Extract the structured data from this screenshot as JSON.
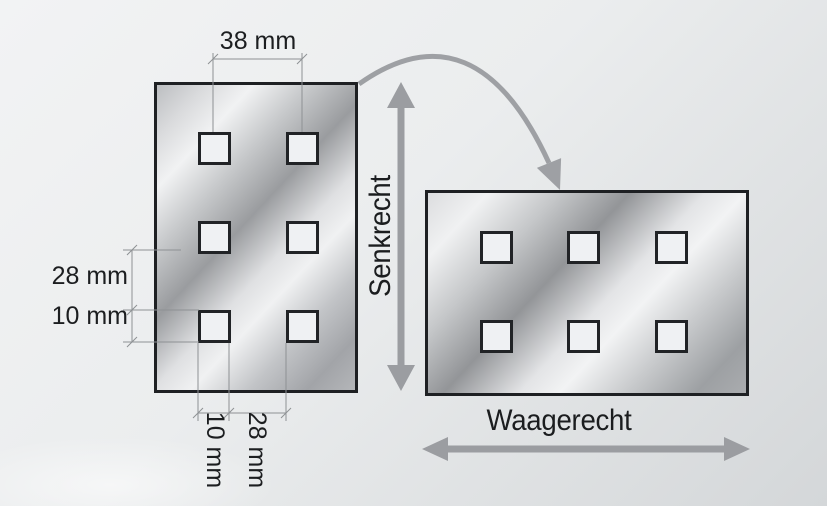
{
  "diagram": {
    "labels": {
      "dim_top": "38 mm",
      "dim_left_gap": "28 mm",
      "dim_left_hole": "10 mm",
      "dim_bottom_hole": "10 mm",
      "dim_bottom_gap": "28 mm",
      "axis_vertical": "Senkrecht",
      "axis_horizontal": "Waagerecht"
    },
    "colors": {
      "arrow_gray": "#9b9da1",
      "dimension_line": "#8e9194",
      "text": "#1c1e20",
      "plate_border": "#1e2023",
      "hole_fill": "#eff1f3"
    },
    "plates": {
      "left": {
        "orientation": "senkrecht",
        "rows": 3,
        "cols": 2,
        "holes": 6
      },
      "right": {
        "orientation": "waagerecht",
        "rows": 2,
        "cols": 3,
        "holes": 6
      }
    }
  }
}
